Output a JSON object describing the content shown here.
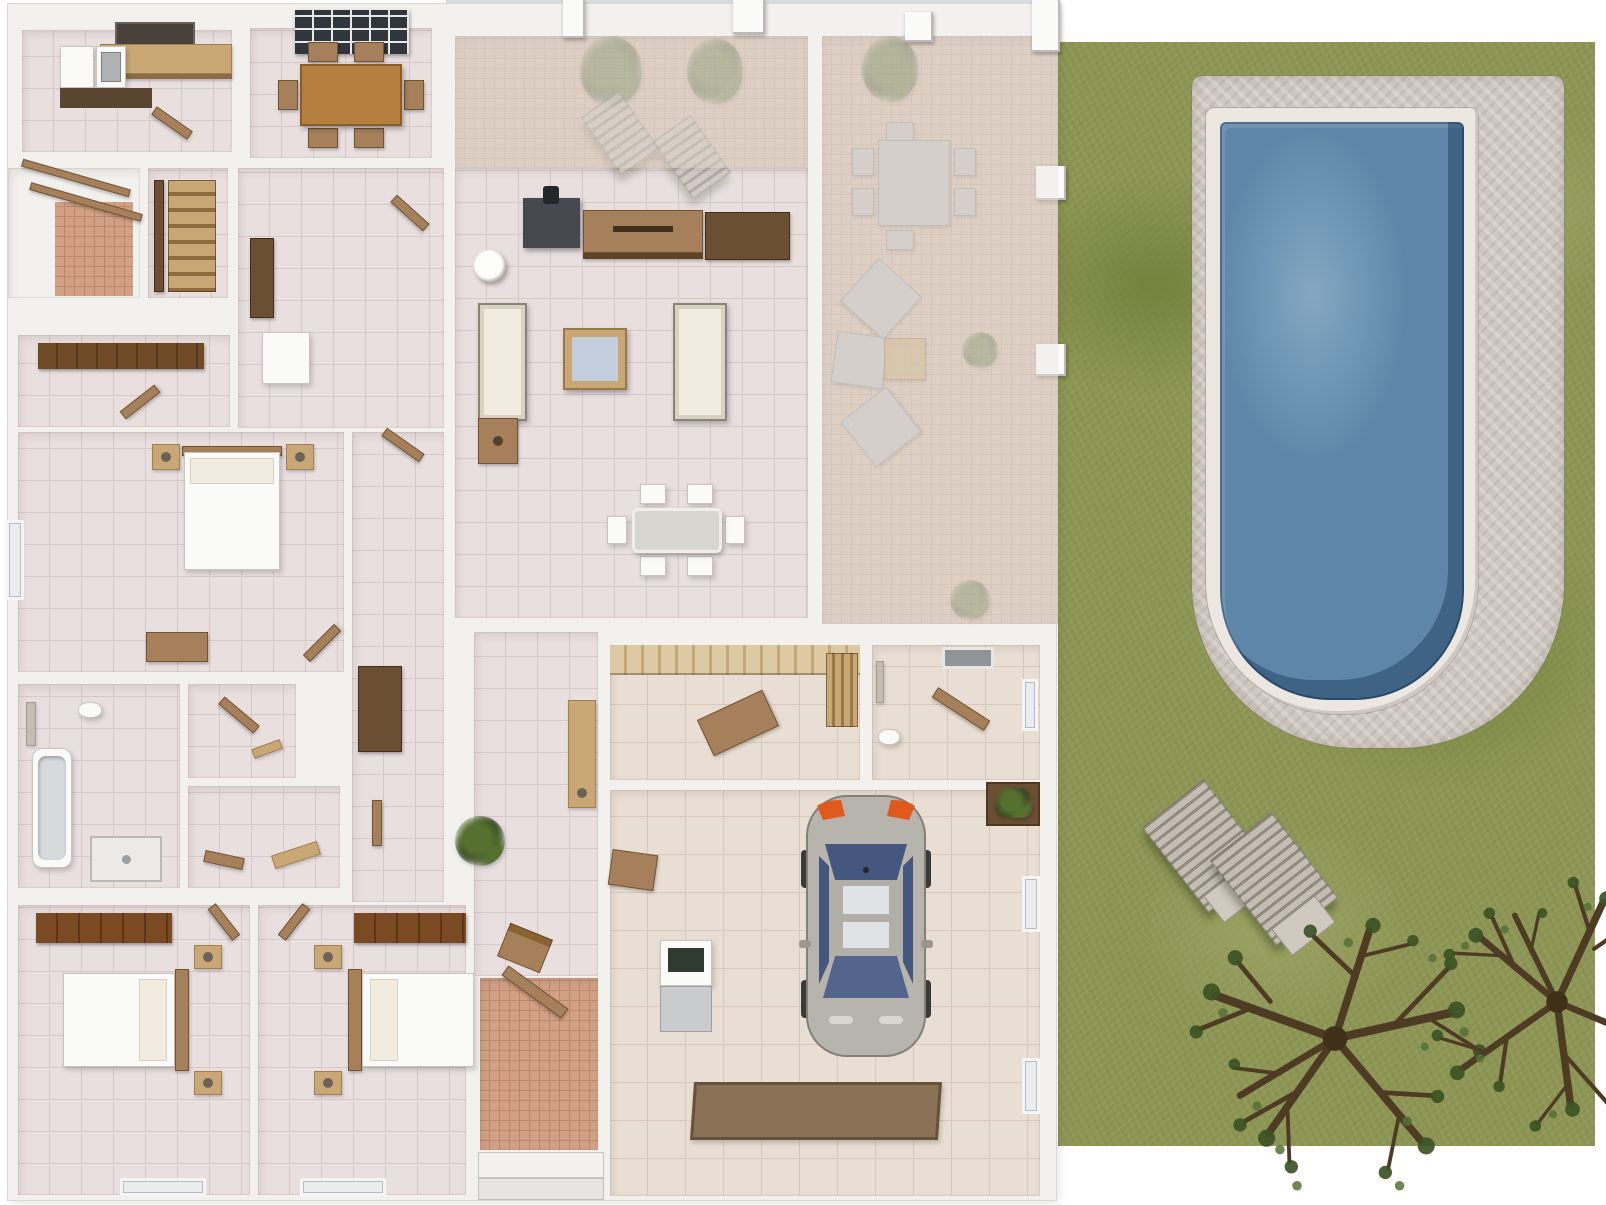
{
  "scene": {
    "kind": "3d-floor-plan-top-view",
    "has_visible_text": false
  },
  "palette": {
    "page_bg": "#ffffff",
    "sky": "#d8dde3",
    "wall": "#f2f1ee",
    "wall_edge": "#dcd8d3",
    "floor_pink": "#e9dfdf",
    "floor_line_pink": "#d7c9ca",
    "floor_beige": "#e9ded3",
    "floor_line_beige": "#d8c9ba",
    "terracotta": "#d2a084",
    "terracotta_line": "#bb8a6c",
    "terracotta_faded": "#d5bcab",
    "terracotta_faded_line": "#c6ab97",
    "overlay_fade": "rgba(233,231,229,0.45)",
    "grass": "#8d9655",
    "grass_dark": "#75833e",
    "grass_light": "#9aa363",
    "deck": "#cfc8c0",
    "deck_light": "#ddd7d0",
    "coping": "#ece7e0",
    "water": "#5d86a8",
    "water_dark": "#2e5677",
    "water_light": "#84a8c3",
    "wood_dark": "#6b4f33",
    "wood_mid": "#a5805a",
    "wood_light": "#c9a876",
    "wood_table": "#b57f42",
    "sofa_white": "#f1ecdf",
    "furn_white": "#fafaf8",
    "tv_dark": "#45494f",
    "glass_blue": "#4f6088",
    "car_body": "#b7b3ad",
    "car_glass": "#46577f",
    "car_taillight": "#e05a1e",
    "gray_furn": "#c3bcb4",
    "plant_green": "#55702f",
    "plant_dark": "#2f4420",
    "mat_brown": "#8a7054",
    "appliance_gray": "#c9cbcd",
    "skylight_dark": "#31363c"
  },
  "house": {
    "rooms": [
      {
        "id": "kitchen",
        "label": "kitchen"
      },
      {
        "id": "dining-room",
        "label": "dining room"
      },
      {
        "id": "courtyard-patio",
        "label": "courtyard patio"
      },
      {
        "id": "staircase",
        "label": "staircase"
      },
      {
        "id": "closet-room",
        "label": "closet room"
      },
      {
        "id": "corridor",
        "label": "corridor"
      },
      {
        "id": "master-bedroom",
        "label": "master bedroom"
      },
      {
        "id": "bathroom-main",
        "label": "main bathroom"
      },
      {
        "id": "wc-1",
        "label": "wc"
      },
      {
        "id": "wc-2",
        "label": "storage"
      },
      {
        "id": "bedroom-left",
        "label": "bedroom"
      },
      {
        "id": "bedroom-right",
        "label": "bedroom"
      },
      {
        "id": "hallway",
        "label": "hallway"
      },
      {
        "id": "entry-vestibule",
        "label": "entry vestibule"
      },
      {
        "id": "living-room",
        "label": "living room"
      },
      {
        "id": "covered-terrace",
        "label": "covered terrace"
      },
      {
        "id": "utility-room",
        "label": "utility room"
      },
      {
        "id": "bathroom-garage",
        "label": "garage bathroom"
      },
      {
        "id": "garage",
        "label": "garage"
      }
    ],
    "furniture": [
      "kitchen-counter",
      "kitchen-sink",
      "fridge",
      "range-hood",
      "dining-table-wood",
      "dining-chairs-6",
      "skylight",
      "tv-cabinet",
      "media-cabinets",
      "floor-lamp",
      "sofa-pair",
      "coffee-table",
      "side-table",
      "indoor-dining-set-white",
      "double-bed-master",
      "nightstands",
      "storage-chest",
      "double-bed-left",
      "double-bed-right",
      "wardrobes",
      "bathtub",
      "shower-tray",
      "sink",
      "wood-doors",
      "outdoor-dining-set",
      "corner-lounge-set",
      "sun-loungers-terrace",
      "palm-plants",
      "car-sedan",
      "water-heater",
      "garage-mat",
      "bench"
    ]
  },
  "yard": {
    "features": [
      {
        "id": "lawn",
        "label": "grass lawn"
      },
      {
        "id": "stone-deck",
        "label": "stone pool deck"
      },
      {
        "id": "swimming-pool",
        "label": "swimming pool"
      },
      {
        "id": "sun-loungers",
        "count": 2
      },
      {
        "id": "trees",
        "count": 2
      }
    ]
  }
}
